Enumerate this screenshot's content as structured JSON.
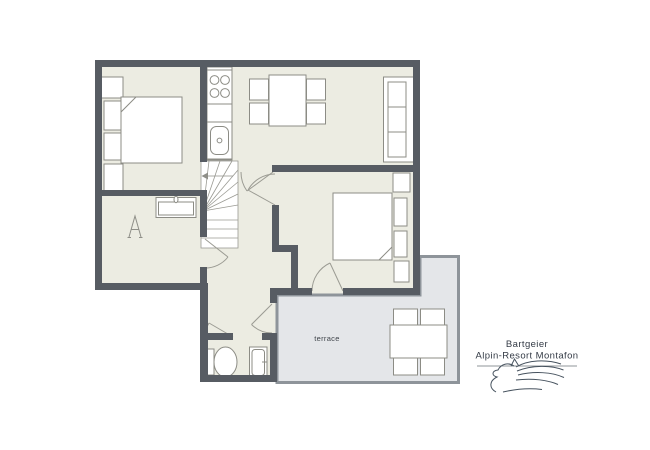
{
  "plan": {
    "terrace_label": "terrace",
    "fixture_a_label": "A"
  },
  "branding": {
    "name": "Bartgeier",
    "subtitle": "Alpin-Resort Montafon",
    "logo_icon": "horse-logo-icon"
  },
  "colors": {
    "background": "#FFFFFF",
    "wall": "#575C63",
    "floor": "#ECECE2",
    "terrace_floor": "#E4E6E9",
    "terrace_border": "#8E949A",
    "furniture_stroke": "#8C8C85",
    "furniture_fill": "#FFFFFF",
    "door_arc": "#9B9B93",
    "text": "#3A4049",
    "logo_stroke": "#46525E"
  }
}
